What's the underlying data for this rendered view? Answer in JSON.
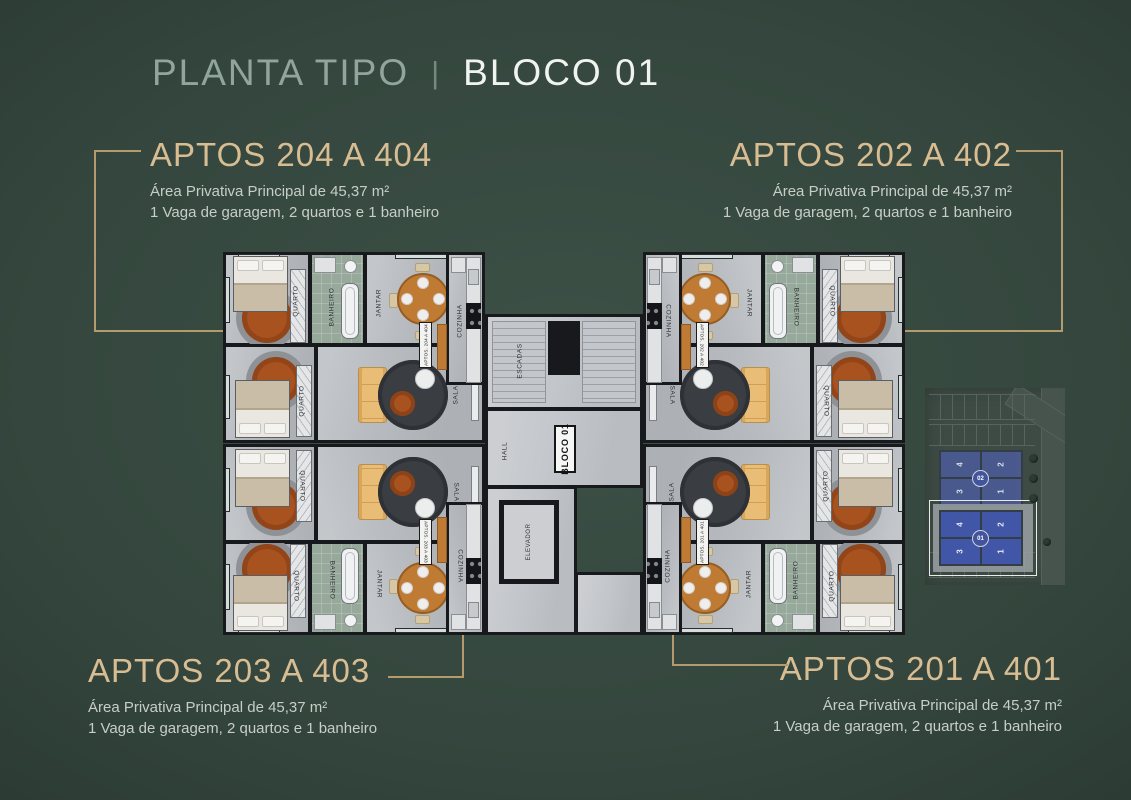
{
  "header": {
    "title_left": "PLANTA TIPO",
    "separator": "|",
    "title_right": "BLOCO 01"
  },
  "units": {
    "u204": {
      "name": "APTOS 204 A 404",
      "area": "Área Privativa Principal de 45,37 m²",
      "features": "1 Vaga de garagem, 2 quartos e 1 banheiro"
    },
    "u202": {
      "name": "APTOS 202 A 402",
      "area": "Área Privativa Principal de 45,37 m²",
      "features": "1 Vaga de garagem, 2 quartos e 1 banheiro"
    },
    "u203": {
      "name": "APTOS 203 A 403",
      "area": "Área Privativa Principal de 45,37 m²",
      "features": "1 Vaga de garagem, 2 quartos e 1 banheiro"
    },
    "u201": {
      "name": "APTOS 201 A 401",
      "area": "Área Privativa Principal de 45,37 m²",
      "features": "1 Vaga de garagem, 2 quartos e 1 banheiro"
    }
  },
  "floorplan": {
    "block_label": "BLOCO 01",
    "core": {
      "stairs": "ESCADAS",
      "hall": "HALL",
      "elevator": "ELEVADOR"
    },
    "room_labels": {
      "bedroom": "QUARTO",
      "bathroom": "BANHEIRO",
      "dining": "JANTAR",
      "kitchen": "COZINHA",
      "living": "SALA"
    },
    "apartments": [
      {
        "quadrant": "top-left",
        "tag": "APTOS. 204 A 404"
      },
      {
        "quadrant": "top-right",
        "tag": "APTOS. 202 A 402"
      },
      {
        "quadrant": "bottom-left",
        "tag": "APTOS. 203 A 403"
      },
      {
        "quadrant": "bottom-right",
        "tag": "APTOS. 201 A 401"
      }
    ]
  },
  "sitemap": {
    "blocks": [
      {
        "label": "02",
        "cells": [
          "4",
          "2",
          "3",
          "1"
        ],
        "highlighted": false
      },
      {
        "label": "01",
        "cells": [
          "4",
          "2",
          "3",
          "1"
        ],
        "highlighted": true
      }
    ]
  },
  "colors": {
    "accent_gold": "#b59a6b",
    "heading_gold": "#d8bd93",
    "title_sage": "#92a59c",
    "title_white": "#f0f4f1",
    "body_text": "#c7cec8",
    "unit_blue": "#4156a6",
    "bg_center": "#3d5147",
    "bg_edge": "#1c2a24"
  }
}
